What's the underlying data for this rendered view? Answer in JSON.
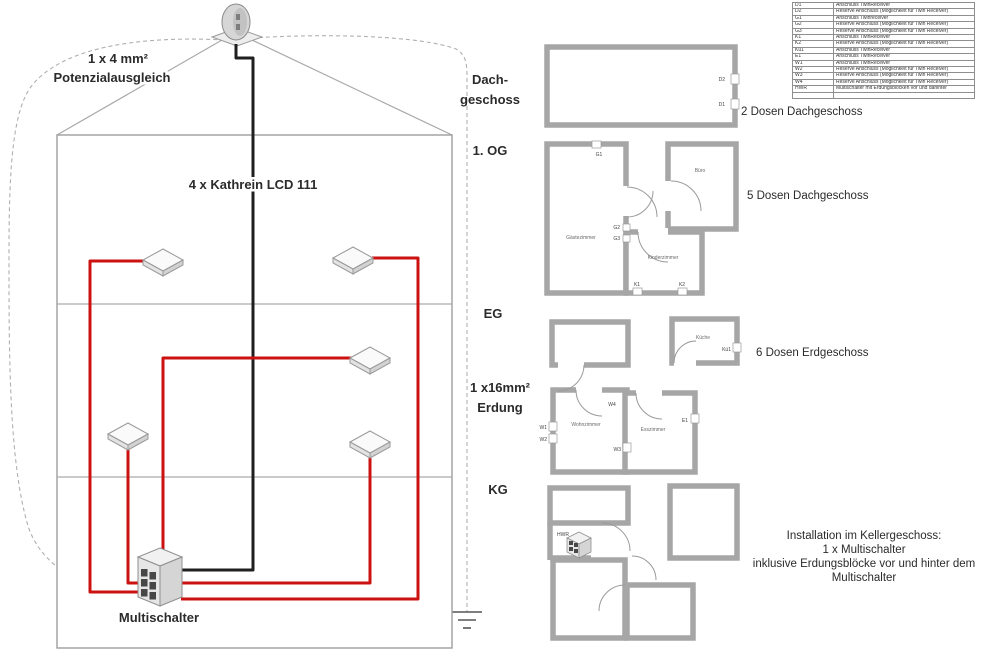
{
  "left": {
    "bonding_line1": "1 x 4 mm²",
    "bonding_line2": "Potenzialausgleich",
    "cable": "4 x Kathrein LCD 111",
    "multiswitch": "Multischalter"
  },
  "middle": {
    "dach1": "Dach-",
    "dach2": "geschoss",
    "og": "1. OG",
    "eg": "EG",
    "erd1": "1 x16mm²",
    "erd2": "Erdung",
    "kg": "KG"
  },
  "right": {
    "dach_note": "2 Dosen Dachgeschoss",
    "og_note": "5 Dosen Dachgeschoss",
    "eg_note": "6 Dosen Erdgeschoss",
    "kg_note1": "Installation im Kellergeschoss:",
    "kg_note2": "1 x Multischalter",
    "kg_note3": "inklusive Erdungsblöcke vor und hinter dem",
    "kg_note4": "Multischalter"
  },
  "plans": {
    "dach": {
      "d2": "D2",
      "d1": "D1"
    },
    "og": {
      "g1": "G1",
      "g2": "G2",
      "g3": "G3",
      "k1": "K1",
      "k2": "K2",
      "room_left": "Gästezimmer",
      "room_top_right": "Büro",
      "room_bottom_right": "Kinderzimmer"
    },
    "eg": {
      "kitchen": "Küche",
      "ku1": "Kü1",
      "e1": "E1",
      "w1": "W1",
      "w2": "W2",
      "w3": "W3",
      "w4": "W4",
      "living": "Wohnzimmer",
      "dining": "Esszimmer"
    },
    "kg": {
      "hwr": "HWR"
    }
  },
  "legend": {
    "rows": [
      {
        "code": "D1",
        "desc": "Anschluss TwinReceiver"
      },
      {
        "code": "D2",
        "desc": "Reserve Anschluss (Möglichkeit für Twin Receiver)"
      },
      {
        "code": "G1",
        "desc": "Anschluss Twinreceiver"
      },
      {
        "code": "G2",
        "desc": "Reserve Anschluss (Möglichkeit für Twin Receiver)"
      },
      {
        "code": "G3",
        "desc": "Reserve Anschluss (Möglichkeit für Twin Receiver)"
      },
      {
        "code": "K1",
        "desc": "Anschluss TwinReceiver"
      },
      {
        "code": "K2",
        "desc": "Reserve Anschluss (Möglichkeit für Twin Receiver)"
      },
      {
        "code": "Kü1",
        "desc": "Anschluss TwinReceiver"
      },
      {
        "code": "E1",
        "desc": "Anschluss TwinReceiver"
      },
      {
        "code": "W1",
        "desc": "Anschluss TwinReceiver"
      },
      {
        "code": "W2",
        "desc": "Reserve Anschluss (Möglichkeit für Twin Receiver)"
      },
      {
        "code": "W3",
        "desc": "Reserve Anschluss (Möglichkeit für Twin Receiver)"
      },
      {
        "code": "W4",
        "desc": "Reserve Anschluss (Möglichkeit für Twin Receiver)"
      },
      {
        "code": "HWR",
        "desc": "Multischalter mit Erdungsblöcken vor und dahinter"
      },
      {
        "code": "",
        "desc": ""
      }
    ]
  },
  "colors": {
    "cable_red": "#cc1111",
    "cable_black": "#1f1f1f",
    "wall": "#a6a6a6"
  }
}
